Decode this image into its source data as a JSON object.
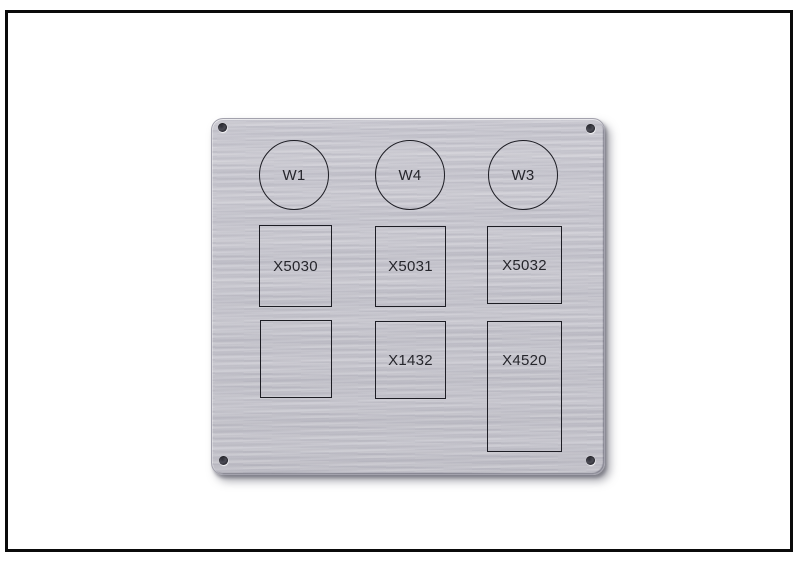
{
  "scene": {
    "subject": "Brushed metal engraving panel plate with four mounting holes",
    "mounting_holes": 4
  },
  "colors": {
    "background": "#ffffff",
    "frame_border": "#0b0b0b",
    "plate_metal": "#c7c6ce",
    "engraving_line": "#1d1d24",
    "label_text": "#26262c"
  },
  "plate": {
    "circles": [
      {
        "label": "W1"
      },
      {
        "label": "W4"
      },
      {
        "label": "W3"
      }
    ],
    "rects_row1": [
      {
        "label": "X5030"
      },
      {
        "label": "X5031"
      },
      {
        "label": "X5032"
      }
    ],
    "rects_row2": [
      {
        "label": ""
      },
      {
        "label": "X1432"
      },
      {
        "label": "X4520"
      }
    ]
  }
}
